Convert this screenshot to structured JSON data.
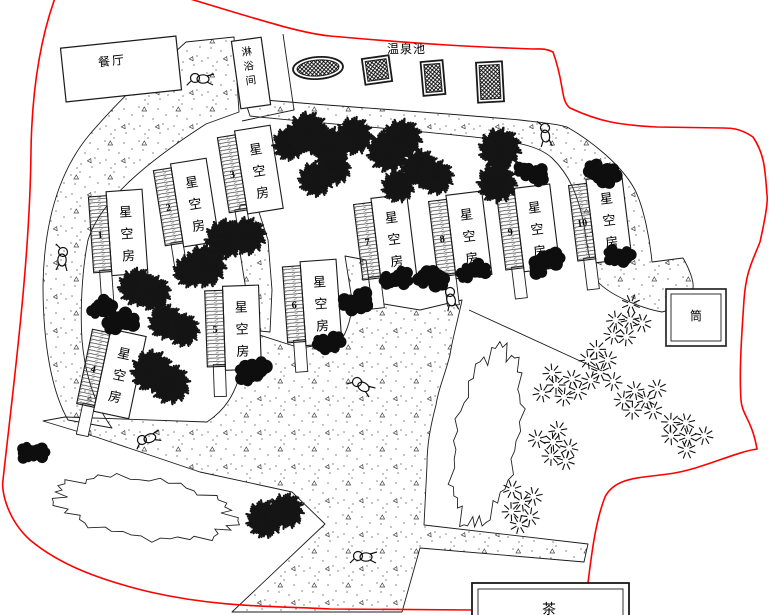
{
  "labels": {
    "restaurant": "餐厅",
    "shower": "淋浴间",
    "hot_spring": "温泉池",
    "tube": "筒",
    "bottom_partial": "茶"
  },
  "rooms": [
    {
      "num": "1",
      "label": "星空房"
    },
    {
      "num": "2",
      "label": "星空房"
    },
    {
      "num": "3",
      "label": "星空房"
    },
    {
      "num": "4",
      "label": "星空房"
    },
    {
      "num": "5",
      "label": "星空房"
    },
    {
      "num": "6",
      "label": "星空房"
    },
    {
      "num": "7",
      "label": "星空房"
    },
    {
      "num": "8",
      "label": "星空房"
    },
    {
      "num": "9",
      "label": "星空房"
    },
    {
      "num": "10",
      "label": "星空房"
    }
  ],
  "colors": {
    "boundary": "#ff0000",
    "ink": "#1a1a1a"
  }
}
